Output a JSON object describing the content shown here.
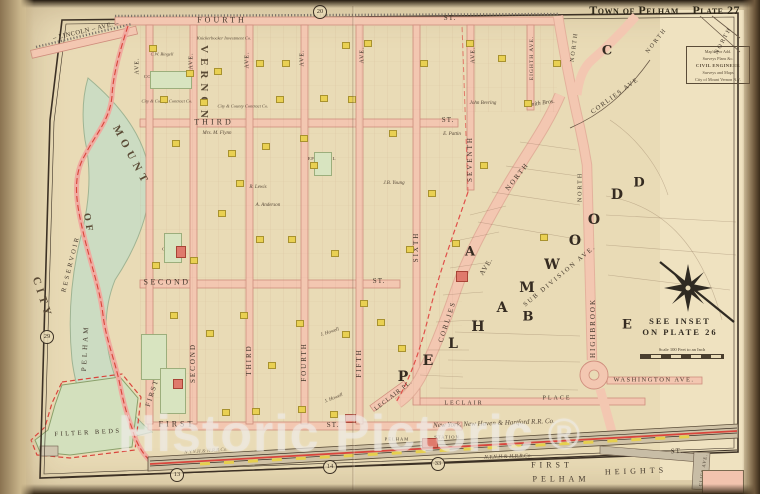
{
  "page": {
    "title_left": "Town of Pelham",
    "title_right": "Plate 27"
  },
  "watermark": {
    "text": "Historic Pictoric",
    "symbol": "®"
  },
  "inset_note": {
    "line1": "SEE INSET",
    "line2": "ON PLATE 26"
  },
  "scale_note": "Scale 100 Feet to an Inch",
  "surveyor_box": {
    "lines": [
      "Map'd For Add.",
      "Surveys Plans &c.",
      "CIVIL ENGINEER",
      "Surveys and Maps",
      "City of Mount Vernon N.Y."
    ]
  },
  "colors": {
    "paper": "#e9dbb6",
    "road_pink": "#f3c7b1",
    "water_green": "#ccdcc2",
    "building_yellow": "#e9d052",
    "building_red": "#df7a6c",
    "boundary_red": "#d9453c",
    "railroad_gray": "#cfc2a6",
    "ink": "#43382c"
  },
  "circles": [
    {
      "label": "20",
      "x": 320,
      "y": 12
    },
    {
      "label": "29",
      "x": 47,
      "y": 337
    },
    {
      "label": "13",
      "x": 177,
      "y": 475
    },
    {
      "label": "14",
      "x": 330,
      "y": 467
    },
    {
      "label": "33",
      "x": 438,
      "y": 464
    }
  ],
  "map_labels": [
    {
      "n": "label-fourth-st",
      "t": "FOURTH",
      "x": 222,
      "y": 21,
      "s": 8,
      "ls": 3
    },
    {
      "n": "label-fourth-st-suffix",
      "t": "ST.",
      "x": 450,
      "y": 19,
      "s": 7,
      "ls": 1
    },
    {
      "n": "label-lincoln-ave",
      "t": "– LINCOLN – AVE. –",
      "x": 86,
      "y": 31,
      "r": -13,
      "s": 6.5,
      "ls": 0.5
    },
    {
      "n": "label-third-st",
      "t": "THIRD",
      "x": 214,
      "y": 123,
      "s": 8,
      "ls": 3
    },
    {
      "n": "label-third-st-suffix",
      "t": "ST.",
      "x": 448,
      "y": 121,
      "s": 7,
      "ls": 1
    },
    {
      "n": "label-second-st",
      "t": "SECOND",
      "x": 167,
      "y": 283,
      "s": 8,
      "ls": 2.5
    },
    {
      "n": "label-second-st-suffix",
      "t": "ST.",
      "x": 379,
      "y": 282,
      "s": 7,
      "ls": 1
    },
    {
      "n": "label-first-st",
      "t": "FIRST",
      "x": 177,
      "y": 425,
      "s": 8,
      "ls": 3
    },
    {
      "n": "label-first-st-suffix",
      "t": "ST.",
      "x": 333,
      "y": 426,
      "s": 7,
      "ls": 1
    },
    {
      "n": "label-first-ave",
      "t": "FIRST",
      "x": 153,
      "y": 393,
      "r": -72,
      "s": 7,
      "ls": 2
    },
    {
      "n": "label-second-ave",
      "t": "SECOND",
      "x": 194,
      "y": 363,
      "r": -90,
      "s": 7,
      "ls": 2
    },
    {
      "n": "label-third-ave",
      "t": "THIRD",
      "x": 250,
      "y": 360,
      "r": -90,
      "s": 7,
      "ls": 2
    },
    {
      "n": "label-fourth-ave",
      "t": "FOURTH",
      "x": 305,
      "y": 362,
      "r": -90,
      "s": 7,
      "ls": 2
    },
    {
      "n": "label-fifth-ave",
      "t": "FIFTH",
      "x": 360,
      "y": 363,
      "r": -90,
      "s": 7,
      "ls": 2
    },
    {
      "n": "label-sixth-ave",
      "t": "SIXTH",
      "x": 417,
      "y": 247,
      "r": -90,
      "s": 7,
      "ls": 2
    },
    {
      "n": "label-seventh-ave",
      "t": "SEVENTH",
      "x": 471,
      "y": 159,
      "r": -90,
      "s": 7,
      "ls": 2
    },
    {
      "n": "label-eighth-ave",
      "t": "EIGHTH AVE.",
      "x": 532,
      "y": 58,
      "r": -90,
      "s": 5.5,
      "ls": 1
    },
    {
      "n": "label-ave-1",
      "t": "AVE.",
      "x": 138,
      "y": 66,
      "r": -90,
      "s": 6,
      "ls": 1
    },
    {
      "n": "label-ave-2",
      "t": "AVE.",
      "x": 192,
      "y": 61,
      "r": -90,
      "s": 6,
      "ls": 1
    },
    {
      "n": "label-ave-3",
      "t": "AVE.",
      "x": 248,
      "y": 60,
      "r": -90,
      "s": 6,
      "ls": 1
    },
    {
      "n": "label-ave-4",
      "t": "AVE.",
      "x": 303,
      "y": 58,
      "r": -90,
      "s": 6,
      "ls": 1
    },
    {
      "n": "label-ave-5",
      "t": "AVE.",
      "x": 363,
      "y": 55,
      "r": -90,
      "s": 6,
      "ls": 1
    },
    {
      "n": "label-ave-7",
      "t": "AVE.",
      "x": 474,
      "y": 55,
      "r": -90,
      "s": 6,
      "ls": 1
    },
    {
      "n": "label-corlies",
      "t": "CORLIES",
      "x": 448,
      "y": 322,
      "r": -72,
      "s": 7,
      "ls": 2
    },
    {
      "n": "label-corlies-ave-suffix",
      "t": "AVE.",
      "x": 487,
      "y": 267,
      "r": -58,
      "s": 7,
      "ls": 1
    },
    {
      "n": "label-corlies-north",
      "t": "NORTH",
      "x": 518,
      "y": 177,
      "r": -52,
      "s": 7,
      "ls": 2
    },
    {
      "n": "label-corlies-upper",
      "t": "CORLIES AVE",
      "x": 615,
      "y": 96,
      "r": -36,
      "s": 6.5,
      "ls": 1.5
    },
    {
      "n": "label-highbrook",
      "t": "HIGHBROOK",
      "x": 594,
      "y": 328,
      "r": -90,
      "s": 7,
      "ls": 2
    },
    {
      "n": "label-highbrook-north",
      "t": "NORTH",
      "x": 581,
      "y": 187,
      "r": -90,
      "s": 6,
      "ls": 2
    },
    {
      "n": "label-north-top",
      "t": "NORTH",
      "x": 575,
      "y": 47,
      "r": -83,
      "s": 6,
      "ls": 2
    },
    {
      "n": "label-north-topright",
      "t": "NORTH",
      "x": 657,
      "y": 41,
      "r": -52,
      "s": 6,
      "ls": 2
    },
    {
      "n": "label-north-corner",
      "t": "NORTH",
      "x": 724,
      "y": 41,
      "r": -62,
      "s": 6,
      "ls": 2
    },
    {
      "n": "label-washington-ave",
      "t": "WASHINGTON  AVE.",
      "x": 654,
      "y": 380,
      "s": 6.5,
      "ls": 1.5
    },
    {
      "n": "label-leclair-pl",
      "t": "LECLAIR  PL.",
      "x": 394,
      "y": 396,
      "r": -38,
      "s": 6,
      "ls": 1
    },
    {
      "n": "label-leclair",
      "t": "LECLAIR",
      "x": 464,
      "y": 404,
      "s": 6,
      "ls": 2
    },
    {
      "n": "label-leclair-place",
      "t": "PLACE",
      "x": 557,
      "y": 399,
      "s": 6,
      "ls": 2
    },
    {
      "n": "label-railroad",
      "t": "New York, New Haven & Hartford R.R. Co.",
      "x": 494,
      "y": 424,
      "r": -2,
      "s": 7,
      "c": "ital"
    },
    {
      "n": "label-railroad-2",
      "t": "N.Y.N.H.& H.R.R.Co.",
      "x": 508,
      "y": 457,
      "r": -2,
      "s": 5.5,
      "c": "ital"
    },
    {
      "n": "label-railroad-3",
      "t": "N.Y.N.H.& H.R.R.Co.",
      "x": 206,
      "y": 452,
      "r": -4,
      "s": 5,
      "c": "ital faint"
    },
    {
      "n": "label-pelham-station",
      "t": "PELHAM",
      "x": 397,
      "y": 439,
      "s": 4.5,
      "ls": 1
    },
    {
      "n": "label-pelham-station-2",
      "t": "STATION",
      "x": 447,
      "y": 437,
      "s": 4.5,
      "ls": 1
    },
    {
      "n": "label-first-bottom",
      "t": "FIRST",
      "x": 552,
      "y": 466,
      "s": 8,
      "ls": 4
    },
    {
      "n": "label-pelham-heights-1",
      "t": "PELHAM",
      "x": 561,
      "y": 480,
      "s": 8,
      "ls": 4
    },
    {
      "n": "label-pelham-heights-2",
      "t": "HEIGHTS",
      "x": 636,
      "y": 472,
      "r": -2,
      "s": 8,
      "ls": 4
    },
    {
      "n": "label-st-bottomright",
      "t": "ST.",
      "x": 677,
      "y": 452,
      "r": -3,
      "s": 7,
      "ls": 1
    },
    {
      "n": "label-cliff-ave",
      "t": "CLIFF AVE.",
      "x": 703,
      "y": 470,
      "r": -80,
      "s": 4.5,
      "ls": 1
    },
    {
      "n": "label-city",
      "t": "CITY",
      "x": 42,
      "y": 298,
      "r": 72,
      "s": 11,
      "ls": 4,
      "c": "arc"
    },
    {
      "n": "label-of",
      "t": "OF",
      "x": 88,
      "y": 224,
      "r": 80,
      "s": 10,
      "ls": 4,
      "c": "arc"
    },
    {
      "n": "label-mount",
      "t": "MOUNT",
      "x": 131,
      "y": 156,
      "r": 62,
      "s": 11,
      "ls": 5,
      "c": "arc"
    },
    {
      "n": "label-vernon",
      "t": "VERNON",
      "x": 204,
      "y": 84,
      "r": 90,
      "s": 11,
      "ls": 5,
      "c": "arc"
    },
    {
      "n": "label-pelham-reservoir-1",
      "t": "PELHAM",
      "x": 86,
      "y": 348,
      "r": -87,
      "s": 7,
      "ls": 3
    },
    {
      "n": "label-pelham-reservoir-2",
      "t": "RESERVOIR",
      "x": 71,
      "y": 264,
      "r": -76,
      "s": 6.5,
      "ls": 2.5
    },
    {
      "n": "label-filter-beds",
      "t": "FILTER BEDS",
      "x": 88,
      "y": 433,
      "r": -3,
      "s": 6.5,
      "ls": 2.5
    },
    {
      "n": "letter-p",
      "t": "P",
      "x": 403,
      "y": 378,
      "s": 14,
      "c": "bigletter"
    },
    {
      "n": "letter-e",
      "t": "E",
      "x": 428,
      "y": 362,
      "s": 14,
      "c": "bigletter"
    },
    {
      "n": "letter-l",
      "t": "L",
      "x": 453,
      "y": 345,
      "s": 14,
      "c": "bigletter"
    },
    {
      "n": "letter-h",
      "t": "H",
      "x": 478,
      "y": 328,
      "s": 14,
      "c": "bigletter"
    },
    {
      "n": "letter-a",
      "t": "A",
      "x": 502,
      "y": 309,
      "s": 14,
      "c": "bigletter"
    },
    {
      "n": "letter-m",
      "t": "M",
      "x": 527,
      "y": 289,
      "s": 14,
      "c": "bigletter"
    },
    {
      "n": "letter-w",
      "t": "W",
      "x": 552,
      "y": 266,
      "s": 14,
      "c": "bigletter"
    },
    {
      "n": "letter-o1",
      "t": "O",
      "x": 575,
      "y": 242,
      "s": 14,
      "c": "bigletter"
    },
    {
      "n": "letter-o2",
      "t": "O",
      "x": 594,
      "y": 221,
      "s": 14,
      "c": "bigletter"
    },
    {
      "n": "letter-d",
      "t": "D",
      "x": 617,
      "y": 196,
      "s": 14,
      "c": "bigletter"
    },
    {
      "n": "section-a",
      "t": "A",
      "x": 470,
      "y": 253,
      "s": 13,
      "c": "bigletter"
    },
    {
      "n": "section-b",
      "t": "B",
      "x": 528,
      "y": 318,
      "s": 13,
      "c": "bigletter"
    },
    {
      "n": "section-c",
      "t": "C",
      "x": 607,
      "y": 52,
      "s": 13,
      "c": "bigletter"
    },
    {
      "n": "section-d",
      "t": "D",
      "x": 639,
      "y": 184,
      "s": 13,
      "c": "bigletter"
    },
    {
      "n": "section-e",
      "t": "E",
      "x": 627,
      "y": 326,
      "s": 13,
      "c": "bigletter"
    },
    {
      "n": "label-subdivision",
      "t": "SUB DIVISION AVE.",
      "x": 560,
      "y": 276,
      "r": -40,
      "s": 6.5,
      "ls": 2
    },
    {
      "n": "label-congregational-church",
      "t": "CONGREGATIONAL\nCHURCH",
      "x": 168,
      "y": 79,
      "s": 4.5,
      "ls": 0.5
    },
    {
      "n": "label-episcopal-chapel",
      "t": "EPISCOPAL\nCHAPEL",
      "x": 322,
      "y": 161,
      "s": 4.5,
      "ls": 0.5
    },
    {
      "n": "label-church",
      "t": "CHURCH",
      "x": 173,
      "y": 249,
      "s": 4.5,
      "ls": 0.5
    },
    {
      "n": "owner-smith-bros",
      "t": "Smith Bros.",
      "x": 541,
      "y": 104,
      "r": -8,
      "s": 6,
      "c": "ital"
    },
    {
      "n": "owner-1",
      "t": "Knickerbocker Investment Co.",
      "x": 224,
      "y": 38,
      "s": 4.5,
      "c": "ital"
    },
    {
      "n": "owner-2",
      "t": "City & County Contract Co.",
      "x": 167,
      "y": 101,
      "s": 4.5,
      "c": "ital"
    },
    {
      "n": "owner-3",
      "t": "City & County Contract Co.",
      "x": 243,
      "y": 106,
      "s": 4.5,
      "c": "ital"
    },
    {
      "n": "owner-4",
      "t": "Mrs. M. Flynn",
      "x": 217,
      "y": 134,
      "s": 5,
      "c": "ital"
    },
    {
      "n": "owner-5",
      "t": "John Bevring",
      "x": 483,
      "y": 104,
      "s": 5,
      "c": "ital"
    },
    {
      "n": "owner-6",
      "t": "J.B. Young",
      "x": 394,
      "y": 184,
      "s": 5,
      "c": "ital"
    },
    {
      "n": "owner-7",
      "t": "J. Howell",
      "x": 330,
      "y": 333,
      "r": -18,
      "s": 5,
      "c": "ital"
    },
    {
      "n": "owner-8",
      "t": "J. Howell",
      "x": 334,
      "y": 399,
      "r": -22,
      "s": 5,
      "c": "ital"
    },
    {
      "n": "owner-9",
      "t": "R. Lewis",
      "x": 258,
      "y": 188,
      "s": 5,
      "c": "ital"
    },
    {
      "n": "owner-10",
      "t": "A. Anderson",
      "x": 268,
      "y": 206,
      "s": 5,
      "c": "ital"
    },
    {
      "n": "owner-11",
      "t": "E. Pattin",
      "x": 452,
      "y": 135,
      "s": 5,
      "c": "ital"
    },
    {
      "n": "owner-12",
      "t": "C.W. Bingell",
      "x": 162,
      "y": 54,
      "s": 4.5,
      "c": "ital"
    }
  ],
  "buildings": {
    "yellow": [
      [
        149,
        45
      ],
      [
        160,
        96
      ],
      [
        172,
        140
      ],
      [
        186,
        70
      ],
      [
        200,
        99
      ],
      [
        214,
        68
      ],
      [
        228,
        150
      ],
      [
        256,
        60
      ],
      [
        262,
        143
      ],
      [
        276,
        96
      ],
      [
        288,
        236
      ],
      [
        296,
        320
      ],
      [
        310,
        162
      ],
      [
        320,
        95
      ],
      [
        331,
        250
      ],
      [
        342,
        331
      ],
      [
        364,
        40
      ],
      [
        377,
        319
      ],
      [
        389,
        130
      ],
      [
        420,
        60
      ],
      [
        428,
        190
      ],
      [
        452,
        240
      ],
      [
        466,
        40
      ],
      [
        480,
        162
      ],
      [
        498,
        55
      ],
      [
        524,
        100
      ],
      [
        540,
        234
      ],
      [
        553,
        60
      ],
      [
        218,
        210
      ],
      [
        190,
        257
      ],
      [
        240,
        312
      ],
      [
        268,
        362
      ],
      [
        298,
        406
      ],
      [
        330,
        411
      ],
      [
        360,
        300
      ],
      [
        398,
        345
      ],
      [
        170,
        312
      ],
      [
        152,
        262
      ],
      [
        236,
        180
      ],
      [
        206,
        330
      ],
      [
        282,
        60
      ],
      [
        348,
        96
      ],
      [
        406,
        246
      ],
      [
        342,
        42
      ],
      [
        252,
        408
      ],
      [
        222,
        409
      ],
      [
        300,
        135
      ],
      [
        256,
        236
      ]
    ],
    "red": [
      [
        176,
        246,
        8,
        10
      ],
      [
        456,
        271,
        10,
        9
      ],
      [
        422,
        438,
        14,
        8
      ],
      [
        345,
        414,
        9,
        7
      ],
      [
        173,
        379,
        8,
        8
      ]
    ],
    "green": [
      [
        150,
        71,
        40,
        16
      ],
      [
        314,
        152,
        16,
        22
      ],
      [
        164,
        233,
        16,
        28
      ],
      [
        141,
        334,
        24,
        44
      ],
      [
        160,
        368,
        24,
        44
      ]
    ]
  }
}
